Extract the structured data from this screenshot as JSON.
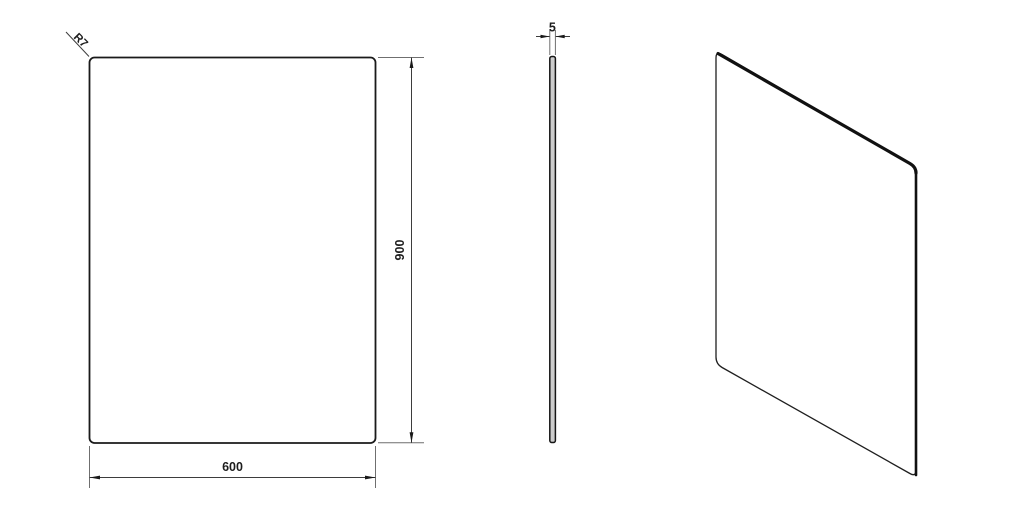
{
  "drawing": {
    "front_view": {
      "width_label": "600",
      "height_label": "900",
      "corner_radius_label": "R7"
    },
    "side_view": {
      "thickness_label": "5"
    }
  },
  "colors": {
    "background": "#ffffff",
    "outline": "#1a1a1a",
    "dimension_line": "#3d3d3d",
    "extension_line": "#6f6f6f",
    "text": "#1d1d1d"
  }
}
